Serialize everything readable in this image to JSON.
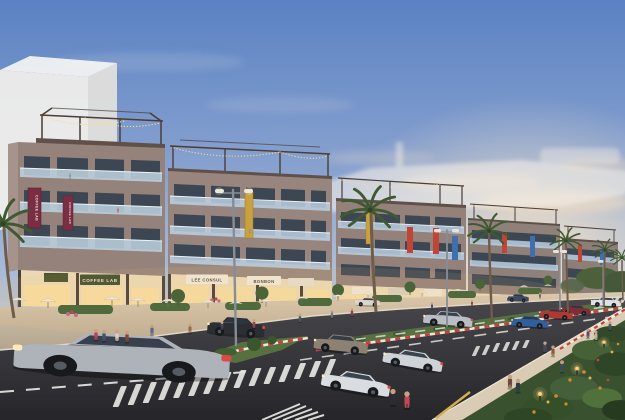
{
  "signs": {
    "banner_a": "COFFEE LAB",
    "banner_b": "COFFEE LAB",
    "shop_a": "COFFEE LAB",
    "shop_b": "LEE CONSUL",
    "shop_c": "BONBON"
  },
  "palette": {
    "sky_top": "#5b82c3",
    "sky_mid": "#a9bcd8",
    "sky_horizon": "#f1debe",
    "sunset_glow": "#ffe9c8",
    "ghost_white": "#f2f0ec",
    "wall": "#93817a",
    "wall_shade": "#5f5049",
    "glass": "#bad0e2",
    "window": "#3d4753",
    "storefront": "#ead8b6",
    "sign_green": "#3e4d2e",
    "sign_board": "#efe8da",
    "banner_maroon": "#7b2d44",
    "banner_gold": "#c9a23f",
    "banner_red": "#c04536",
    "banner_blue": "#3f6fae",
    "string_lights": "#ffd98a",
    "plaza": "#cdbda7",
    "road": "#35353a",
    "marking": "#e6e6e2",
    "curb_red": "#c4403a",
    "curb_white": "#efe8da",
    "median_green": "#56713f",
    "palm_green": "#3f5a33",
    "trunk": "#6f5c49",
    "garden_green": "#3a5130",
    "flower_orange": "#d08a2e",
    "lamp_glow": "#ffd27a",
    "sidewalk": "#d9cbb4"
  },
  "vehicles": [
    {
      "name": "silver-sports-car",
      "color": "#aeb3ba"
    },
    {
      "name": "dark-suv",
      "color": "#2b2e33"
    },
    {
      "name": "white-coupe-front",
      "color": "#d9dce0"
    },
    {
      "name": "white-coupe-rear",
      "color": "#cfd3d8"
    },
    {
      "name": "bronze-suv",
      "color": "#8d8174"
    },
    {
      "name": "silver-sedan",
      "color": "#b9bec5"
    },
    {
      "name": "blue-coupe",
      "color": "#2f5f9e"
    },
    {
      "name": "red-coupe",
      "color": "#b03932"
    },
    {
      "name": "maroon-car",
      "color": "#7c2f38"
    },
    {
      "name": "white-sedan",
      "color": "#dde0e4"
    },
    {
      "name": "white-van",
      "color": "#d8d5cd"
    },
    {
      "name": "navy-car",
      "color": "#3a4a63"
    }
  ]
}
